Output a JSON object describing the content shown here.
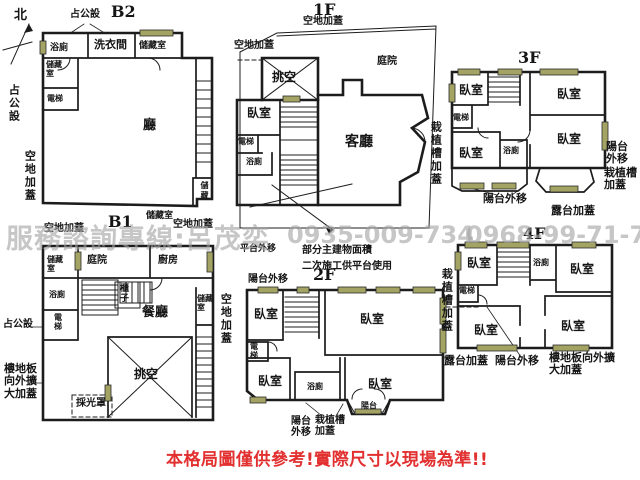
{
  "compass": {
    "north": "北"
  },
  "watermark": {
    "service_line": "服務諮詢專線:呂茂奕",
    "phone_1": "0935-009-734",
    "phone_2": "0968-99-71-75"
  },
  "disclaimer": "本格局圖僅供參考!實際尺寸以現場為準!!",
  "plans": {
    "b2": {
      "title": "B2",
      "note_top": "占公設",
      "rooms": {
        "bath": "浴廁",
        "laundry": "洗衣間",
        "storage_top": "儲藏室",
        "storage_left": "儲藏室",
        "elevator": "電梯",
        "hall": "廳",
        "storage_corner": "儲藏"
      },
      "outside": {
        "public_left": "占公設",
        "open_left": "空地加蓋",
        "storage_bottom": "儲藏室",
        "open_bottom": "空地加蓋"
      }
    },
    "b1": {
      "title": "B1",
      "rooms": {
        "storage_tl": "儲藏室",
        "yard": "庭院",
        "kitchen": "廚房",
        "bath": "浴廁",
        "elevator": "電梯",
        "cabinet": "櫃子",
        "dining": "餐廳",
        "void": "挑空",
        "skylight": "採光罩",
        "storage_right": "儲藏室"
      },
      "outside": {
        "open_top": "空地加蓋",
        "public_left": "占公設",
        "expand_left": "樓地板向外擴大加蓋",
        "open_right": "空地加蓋"
      }
    },
    "f1": {
      "title": "1F",
      "rooms": {
        "void": "挑空",
        "bedroom": "臥室",
        "elevator": "電梯",
        "bath": "浴廁",
        "living": "客廳",
        "yard": "庭院"
      },
      "outside": {
        "open_top": "空地加蓋",
        "open_top_left": "空地加蓋"
      }
    },
    "f2": {
      "title": "2F",
      "notes": {
        "platform": "平台外移",
        "line1": "部分主建物面積",
        "line2": "二次施工供平台使用"
      },
      "rooms": {
        "bedroom_tl": "臥室",
        "bedroom_tr": "臥室",
        "elevator": "電梯",
        "bedroom_bl": "臥室",
        "bath": "浴廁",
        "bedroom_br": "臥室",
        "balcony": "陽台"
      },
      "outside": {
        "balcony_top": "陽台外移",
        "balcony_bottom": "陽台外移",
        "planter_bottom": "栽植槽加蓋"
      }
    },
    "f3": {
      "title": "3F",
      "rooms": {
        "bedroom_tl": "臥室",
        "bedroom_tr": "臥室",
        "elevator": "電梯",
        "bedroom_mr": "臥室",
        "bedroom_bl": "臥室",
        "bath": "浴廁"
      },
      "outside": {
        "planter_left": "栽植槽加蓋",
        "balcony_right": "陽台外移",
        "planter_right": "栽植槽加蓋",
        "balcony_bottom": "陽台外移",
        "terrace_bottom": "露台加蓋"
      }
    },
    "f4": {
      "title": "4F",
      "rooms": {
        "bedroom_tl": "臥室",
        "bath": "浴廁",
        "bedroom_tr": "臥室",
        "elevator": "電梯",
        "bedroom_bl": "臥室",
        "bedroom_br": "臥室"
      },
      "outside": {
        "planter_left": "栽植槽加蓋",
        "terrace_bottom": "露台加蓋",
        "balcony_bottom": "陽台外移",
        "expand_bottom": "樓地板向外擴大加蓋"
      }
    }
  },
  "colors": {
    "wall": "#1c1c1c",
    "window_fill": "#a3a363",
    "watermark_gray": "#a3a3a3",
    "warning_red": "#e23030",
    "background": "#ffffff"
  }
}
